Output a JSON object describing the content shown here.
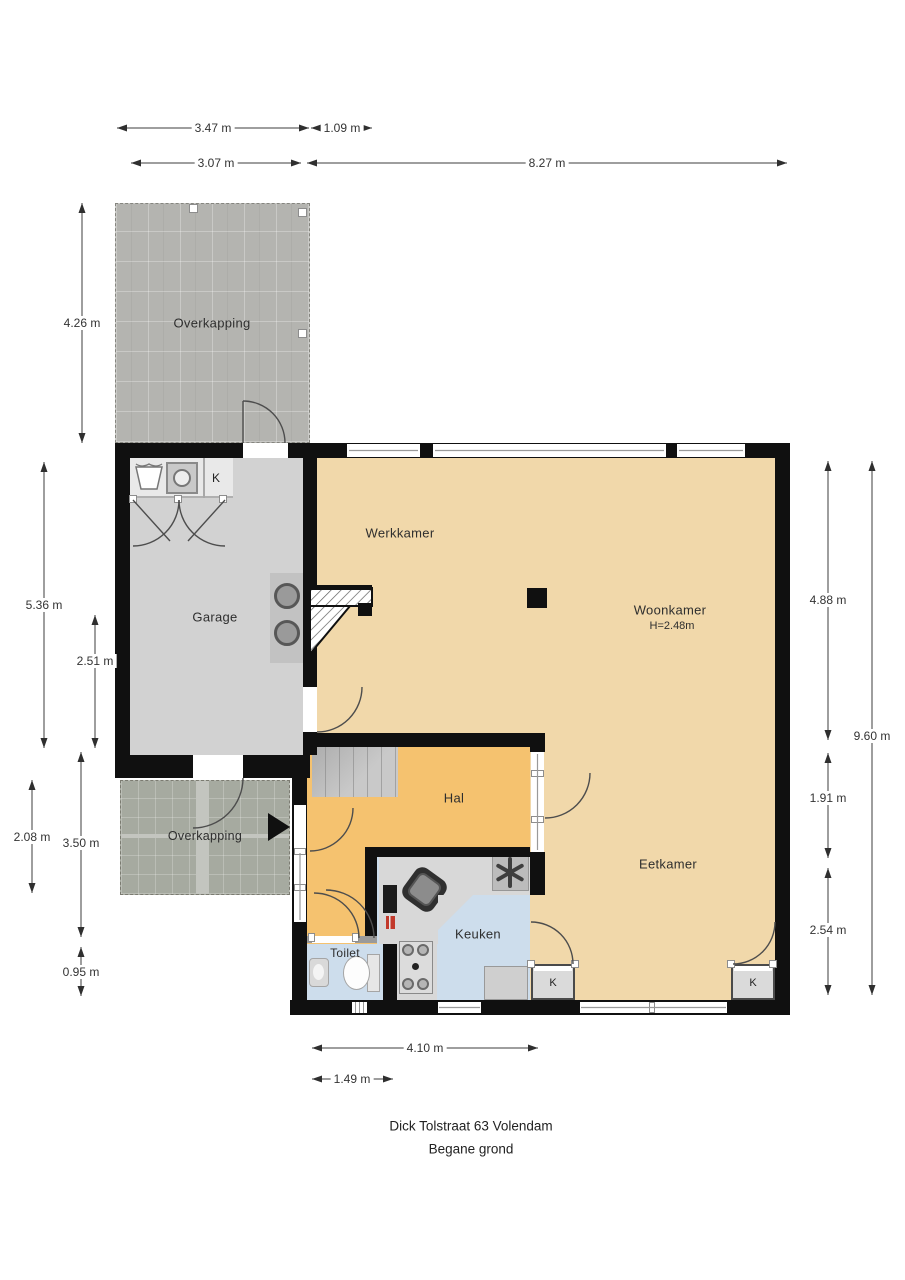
{
  "title": {
    "address": "Dick Tolstraat 63 Volendam",
    "floor": "Begane grond"
  },
  "rooms": {
    "overkapping_top": "Overkapping",
    "werkkamer": "Werkkamer",
    "woonkamer": "Woonkamer",
    "woonkamer_ceiling_height": "H=2.48m",
    "garage": "Garage",
    "garage_closet": "K",
    "hal": "Hal",
    "overkapping_bottom": "Overkapping",
    "eetkamer": "Eetkamer",
    "keuken": "Keuken",
    "toilet": "Toilet",
    "keuken_closet": "K",
    "eetkamer_closet": "K"
  },
  "dimensions": {
    "top": [
      {
        "label": "3.47 m"
      },
      {
        "label": "1.09 m"
      },
      {
        "label": "3.07 m"
      },
      {
        "label": "8.27 m"
      }
    ],
    "left": [
      {
        "label": "4.26 m"
      },
      {
        "label": "5.36 m"
      },
      {
        "label": "2.51 m"
      },
      {
        "label": "2.08 m"
      },
      {
        "label": "3.50 m"
      },
      {
        "label": "0.95 m"
      }
    ],
    "right": [
      {
        "label": "4.88 m"
      },
      {
        "label": "9.60 m"
      },
      {
        "label": "1.91 m"
      },
      {
        "label": "2.54 m"
      }
    ],
    "bottom": [
      {
        "label": "4.10 m"
      },
      {
        "label": "1.49 m"
      }
    ]
  },
  "colors": {
    "floor_living_tan": "#f1d8aa",
    "floor_hall_orange": "#f5c26f",
    "floor_wet_blue": "#cdddec",
    "floor_garage_gray": "#d2d2d2",
    "wall_black": "#101010",
    "overkapping_top_gray": "#b4b4b0",
    "overkapping_bottom_gray": "#a6aaa0",
    "accent_red_marker": "#c2392b"
  }
}
